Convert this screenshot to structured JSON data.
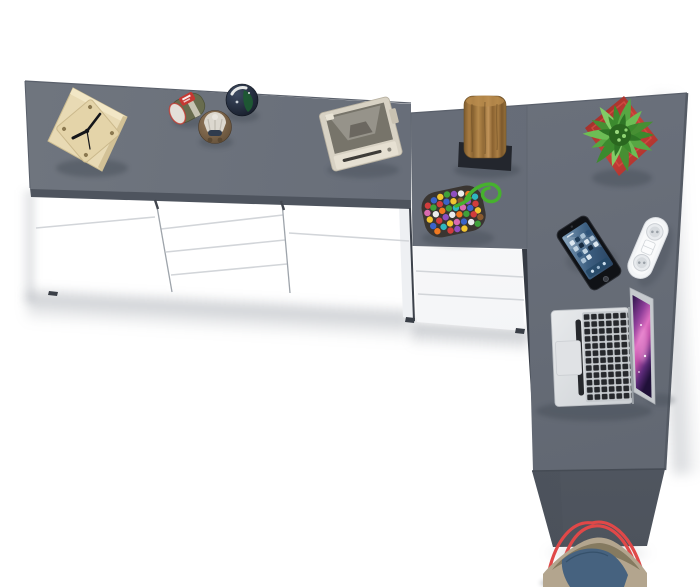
{
  "meta": {
    "type": "product-photo",
    "description": "Top view of an L-shaped home office arrangement: a grey-top sideboard with white fronts, a three-drawer desk pedestal and a grey desk with side support panel, decorated with accessories.",
    "canvas": {
      "width": 700,
      "height": 587
    }
  },
  "palette": {
    "floor": "#ffffff",
    "surface_gray": "#686e79",
    "surface_gray_light": "#70767f",
    "surface_gray_deep": "#5f656f",
    "surface_edge": "#4a505b",
    "panel_top": "#5d636e",
    "panel_bottom": "#4c525b",
    "wedge_dark": "#22262e",
    "front_white": "#fcfdfe",
    "front_shade": "#e1e4e8",
    "seam_line": "#d2d5d9",
    "divider_line": "#9ea4ab",
    "tick_dark": "#41454d",
    "pot_red": "#bf3a31",
    "leaf_green": "#57a743",
    "strap_red": "#e04848",
    "denim_blue": "#46627f",
    "khaki_tan": "#b3a58e"
  },
  "furniture": {
    "sideboard": {
      "label": "Sideboard with grey top, two doors and four centre drawers",
      "sections": [
        "door",
        "four-drawer stack",
        "door"
      ],
      "door_count": 2,
      "drawer_count": 4
    },
    "pedestal": {
      "label": "Desk drawer pedestal with three drawers",
      "drawer_count": 3
    },
    "desk": {
      "label": "Desk with grey top and dark side support panel"
    }
  },
  "objects": {
    "clock": {
      "label": "Wooden cube desk clock"
    },
    "figurine_green": {
      "label": "Olive and red toy figurine"
    },
    "figurine_brown": {
      "label": "Brown figurine with knitted cap"
    },
    "figurine_dark": {
      "label": "Dark glossy bird figurine"
    },
    "camera": {
      "label": "Beige vintage instant camera"
    },
    "log_sculpture": {
      "label": "Wooden log sculpture on black stand"
    },
    "plant": {
      "label": "Green succulent in red square pot"
    },
    "bead_pouch": {
      "label": "Multicoloured bead pouch with green cord"
    },
    "phone": {
      "label": "Smartphone with blue home screen"
    },
    "power_strip": {
      "label": "White two-socket power strip"
    },
    "laptop": {
      "label": "Open silver laptop with purple wallpaper"
    },
    "tote_bag": {
      "label": "Denim and canvas tote bag with red straps"
    }
  }
}
